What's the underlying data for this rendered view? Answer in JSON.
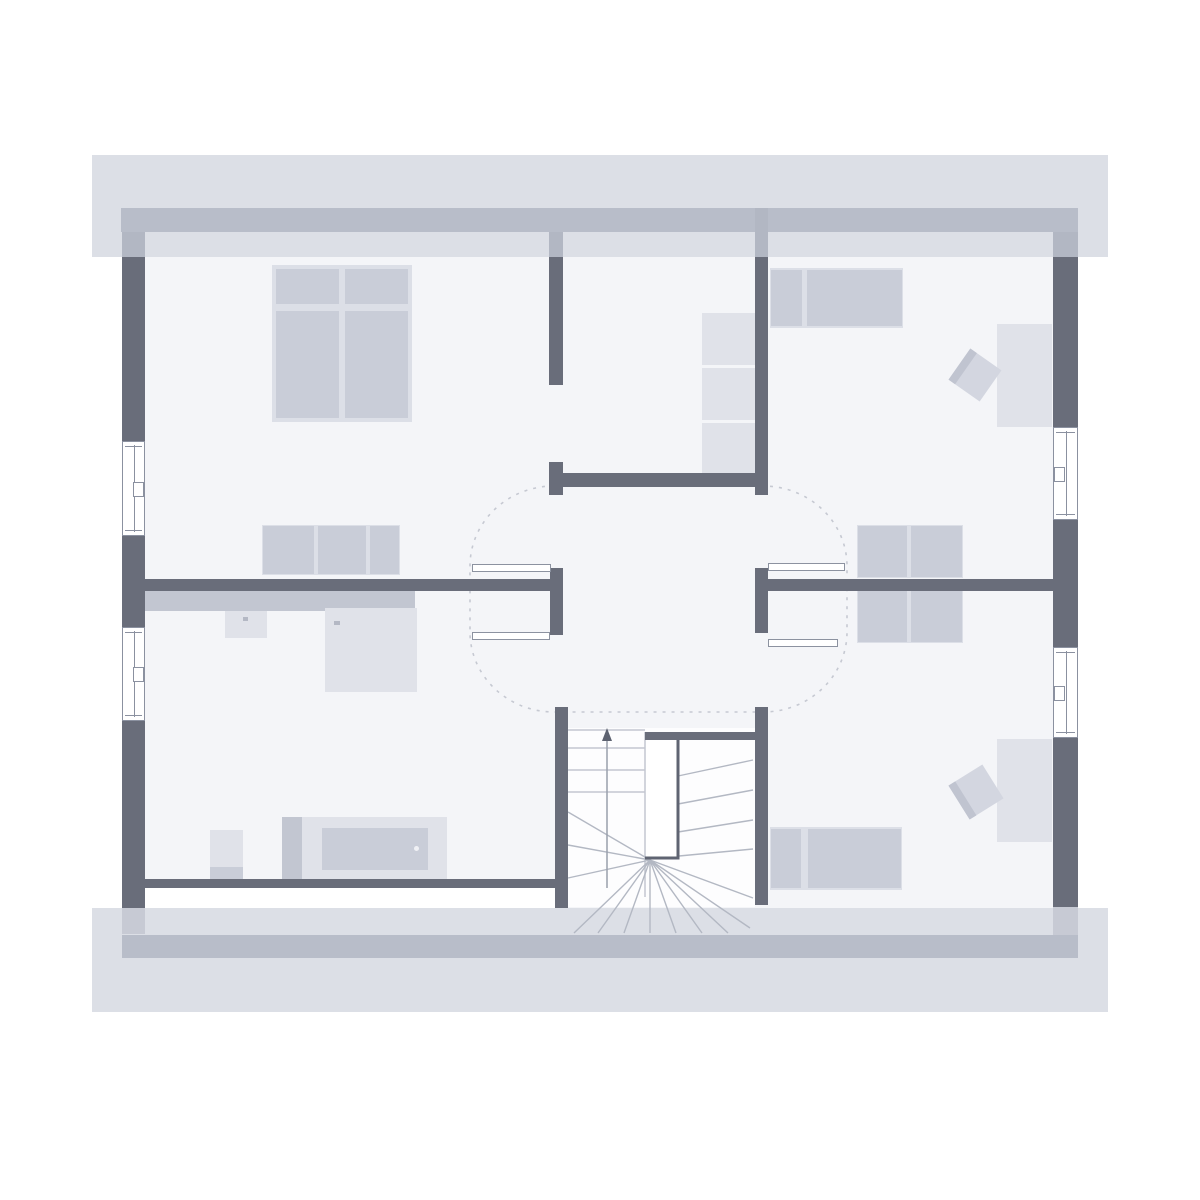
{
  "plan": {
    "kind": "residential floor plan, attic storey, stylized, no text labels rendered",
    "visible_text": [],
    "rooms": [
      {
        "id": "bedroom",
        "label": "Bedroom (top left)"
      },
      {
        "id": "dressing-room",
        "label": "Dressing room (top middle)"
      },
      {
        "id": "room-top-right",
        "label": "Room (top right)"
      },
      {
        "id": "hallway",
        "label": "Hallway (center)"
      },
      {
        "id": "bathroom",
        "label": "Bathroom (bottom left)"
      },
      {
        "id": "stairwell",
        "label": "Winder staircase (bottom middle)"
      },
      {
        "id": "room-bottom-right",
        "label": "Room (bottom right)"
      }
    ],
    "furniture": [
      {
        "room": "bedroom",
        "items": [
          "double-bed",
          "sideboard"
        ]
      },
      {
        "room": "dressing-room",
        "items": [
          "shelf-unit"
        ]
      },
      {
        "room": "room-top-right",
        "items": [
          "bed",
          "desk",
          "chair",
          "dresser"
        ]
      },
      {
        "room": "bathroom",
        "items": [
          "installation-wall",
          "washbasin",
          "shower",
          "wc",
          "bathtub"
        ]
      },
      {
        "room": "room-bottom-right",
        "items": [
          "bed",
          "desk",
          "chair",
          "dresser"
        ]
      }
    ],
    "counts": {
      "windows": 4,
      "hinged_door_leaves": 4,
      "open_doorways": 1,
      "stair_flights": "U-shaped winder stair with void"
    },
    "palette": {
      "background": "#ffffff",
      "floor": "#f4f5f8",
      "roof_overhang": "#dcdfe6",
      "roof_edge_strip": "#b8bdc9",
      "wall": "#696d7a",
      "furniture_light": "#e0e2e9",
      "furniture_mid": "#c9cdd8",
      "furniture_dark": "#c2c6d1",
      "stair_outline": "#5f6472",
      "dashed_swing_line": "#c6c9d2",
      "window_frame": "#8b91a0"
    }
  }
}
